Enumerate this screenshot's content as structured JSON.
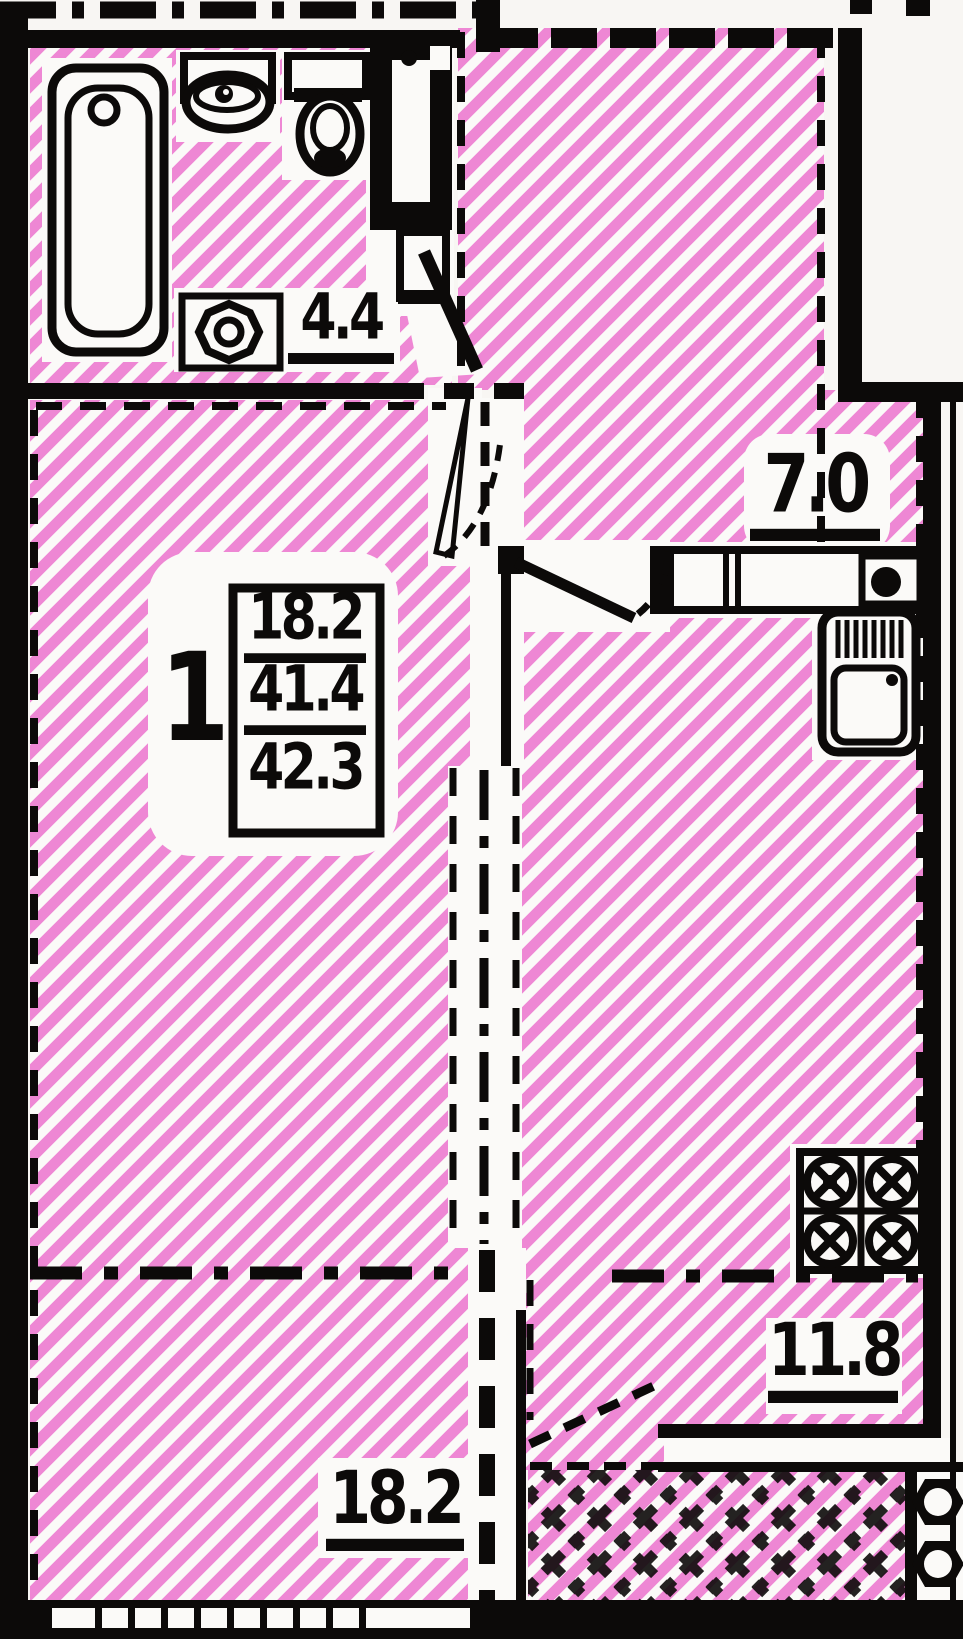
{
  "plan": {
    "summary_box": {
      "rooms_count": "1",
      "living_area": "18.2",
      "apartment_area": "41.4",
      "total_area": "42.3"
    },
    "room_areas": {
      "bathroom": "4.4",
      "kitchen": "7.0",
      "hall": "11.8",
      "living_room": "18.2"
    },
    "colors": {
      "hatch_pink": "#ee87d4",
      "ink_black": "#0c0a09",
      "paper": "#f8f6f3"
    },
    "icons": [
      "bathtub-icon",
      "wash-basin-icon",
      "toilet-icon",
      "washing-machine-icon",
      "kitchen-counter-icon",
      "kitchen-sink-icon",
      "fridge-icon",
      "stove-4-burner-icon",
      "vent-shaft-icon",
      "door-swing-icon",
      "window-icon"
    ]
  }
}
